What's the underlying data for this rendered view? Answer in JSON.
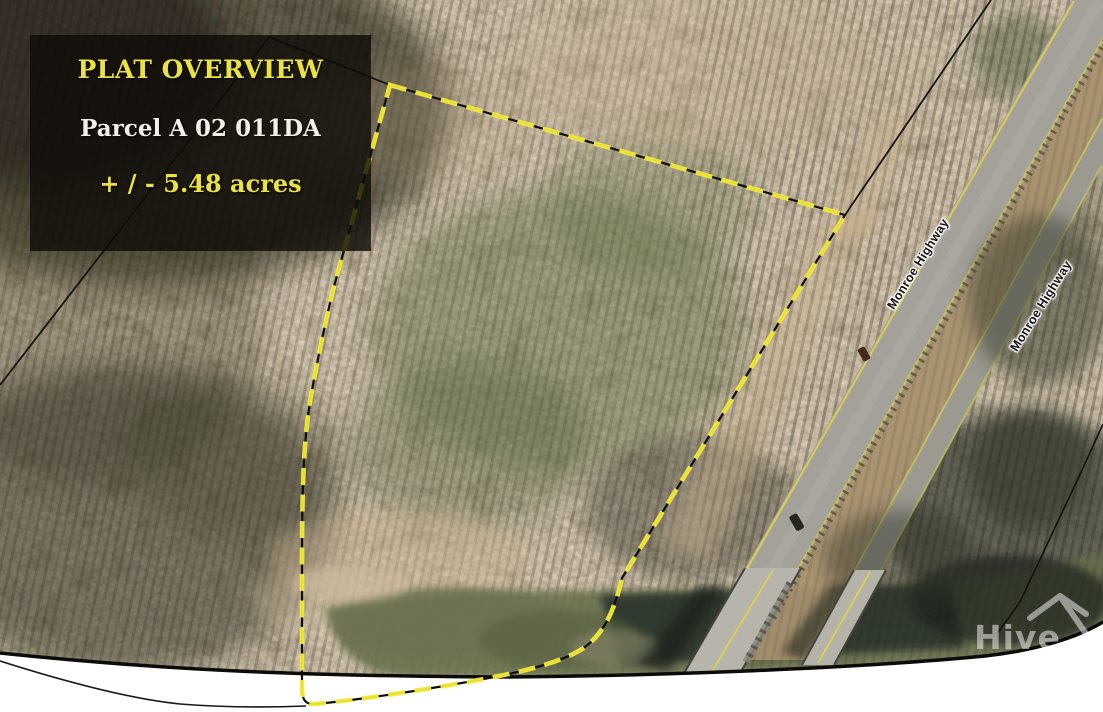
{
  "overlay": {
    "title": "PLAT OVERVIEW",
    "parcel_id": "Parcel A 02 011DA",
    "acreage": "+ / - 5.48 acres"
  },
  "map": {
    "road_labels": [
      {
        "text": "Monroe Highway"
      },
      {
        "text": "Monroe Highway"
      }
    ],
    "colors": {
      "parcel_boundary_yellow": "#f4ec3b",
      "boundary_underlay_black": "#0e0e0c",
      "overlay_panel_bg": "rgba(14,11,7,0.8)",
      "overlay_title_yellow": "#e9e242",
      "overlay_parcel_white": "#f4f0e9",
      "road_surface_gray": "#a3a19a",
      "road_edge_yellow": "#dbcf55",
      "river_green": "#68704e",
      "cutoff_white": "#ffffff"
    }
  },
  "watermark": {
    "text": "Hive"
  }
}
